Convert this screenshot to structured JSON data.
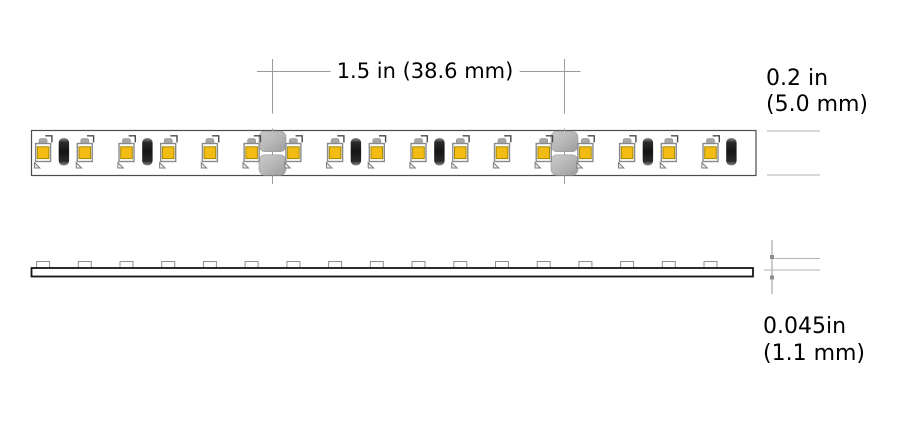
{
  "labels": {
    "pitch": "1.5 in (38.6 mm)",
    "width_in": "0.2 in",
    "width_mm": "(5.0 mm)",
    "thickness_in": "0.045in",
    "thickness_mm": "(1.1 mm)"
  },
  "colors": {
    "led_yellow": "#F3BC14",
    "led_chip_border": "#A68A00",
    "package_outline": "#8A8A8A",
    "resistor_cap": "#8F8F8F",
    "resistor_body": "#141414",
    "pad_gray": "#B7B7B7",
    "strip_border": "#4D4D4D",
    "pcb_outline": "#151515",
    "dim_line": "#9A9A9A",
    "text": "#000000"
  },
  "top_view": {
    "strip": {
      "x": 31.5,
      "y": 130.5,
      "w": 724.5,
      "h": 45
    },
    "led_x": [
      43.1,
      84.8,
      126.5,
      168.2,
      209.9,
      251.6,
      293.4,
      335.1,
      376.8,
      418.5,
      460.3,
      502,
      543.7,
      585.4,
      627.1,
      668.8,
      710.5
    ],
    "resistor_x": [
      63.9,
      147.4,
      355.9,
      439.4,
      647.9,
      731.4
    ],
    "cut_x": [
      272.5,
      564.5
    ]
  },
  "side_view": {
    "bar": {
      "x": 31.5,
      "y": 268,
      "w": 721.5,
      "h": 8.5
    },
    "bump_x": [
      43.1,
      84.8,
      126.5,
      168.2,
      209.9,
      251.6,
      293.4,
      335.1,
      376.8,
      418.5,
      460.3,
      502,
      543.7,
      585.4,
      627.1,
      668.8,
      710.5
    ]
  }
}
